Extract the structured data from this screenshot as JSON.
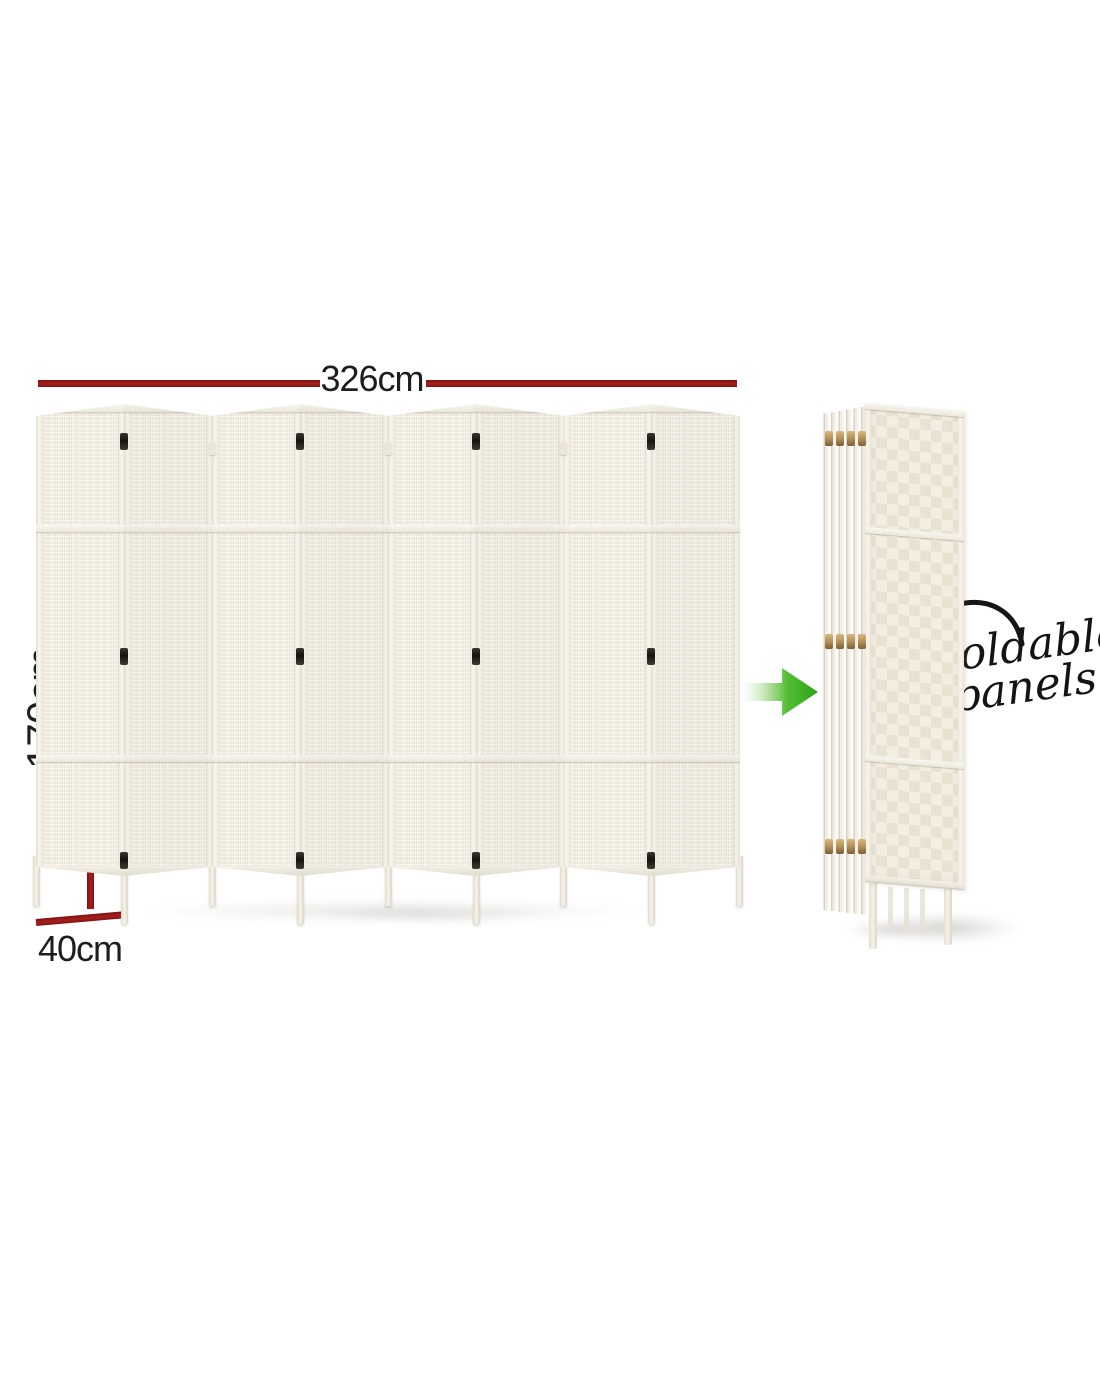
{
  "image_type": "product-dimension-annotation",
  "dimensions": {
    "width_label": "326cm",
    "height_label": "170cm",
    "depth_label": "40cm"
  },
  "callout": {
    "line1": "Foldable",
    "line2": "panels"
  },
  "divider": {
    "panel_count": 8,
    "hinge_rows": 3
  },
  "folded_view": {
    "slat_count": 6
  },
  "icons": {
    "transform_arrow": "green-arrow-icon",
    "callout_arrow": "curved-arrow-icon"
  },
  "colors": {
    "background": "#ffffff",
    "dimension_line": "#a81e1a",
    "dimension_line_dark": "#7c1412",
    "label_text": "#1e1e1e",
    "callout_text": "#141414",
    "arrow_green": "#2aa318",
    "arrow_green_light": "#dff0d5",
    "panel_cream": "#f1ecdf",
    "panel_frame": "#f5f2ea",
    "hinge_black": "#17140f",
    "hinge_brass": "#b5905a"
  }
}
